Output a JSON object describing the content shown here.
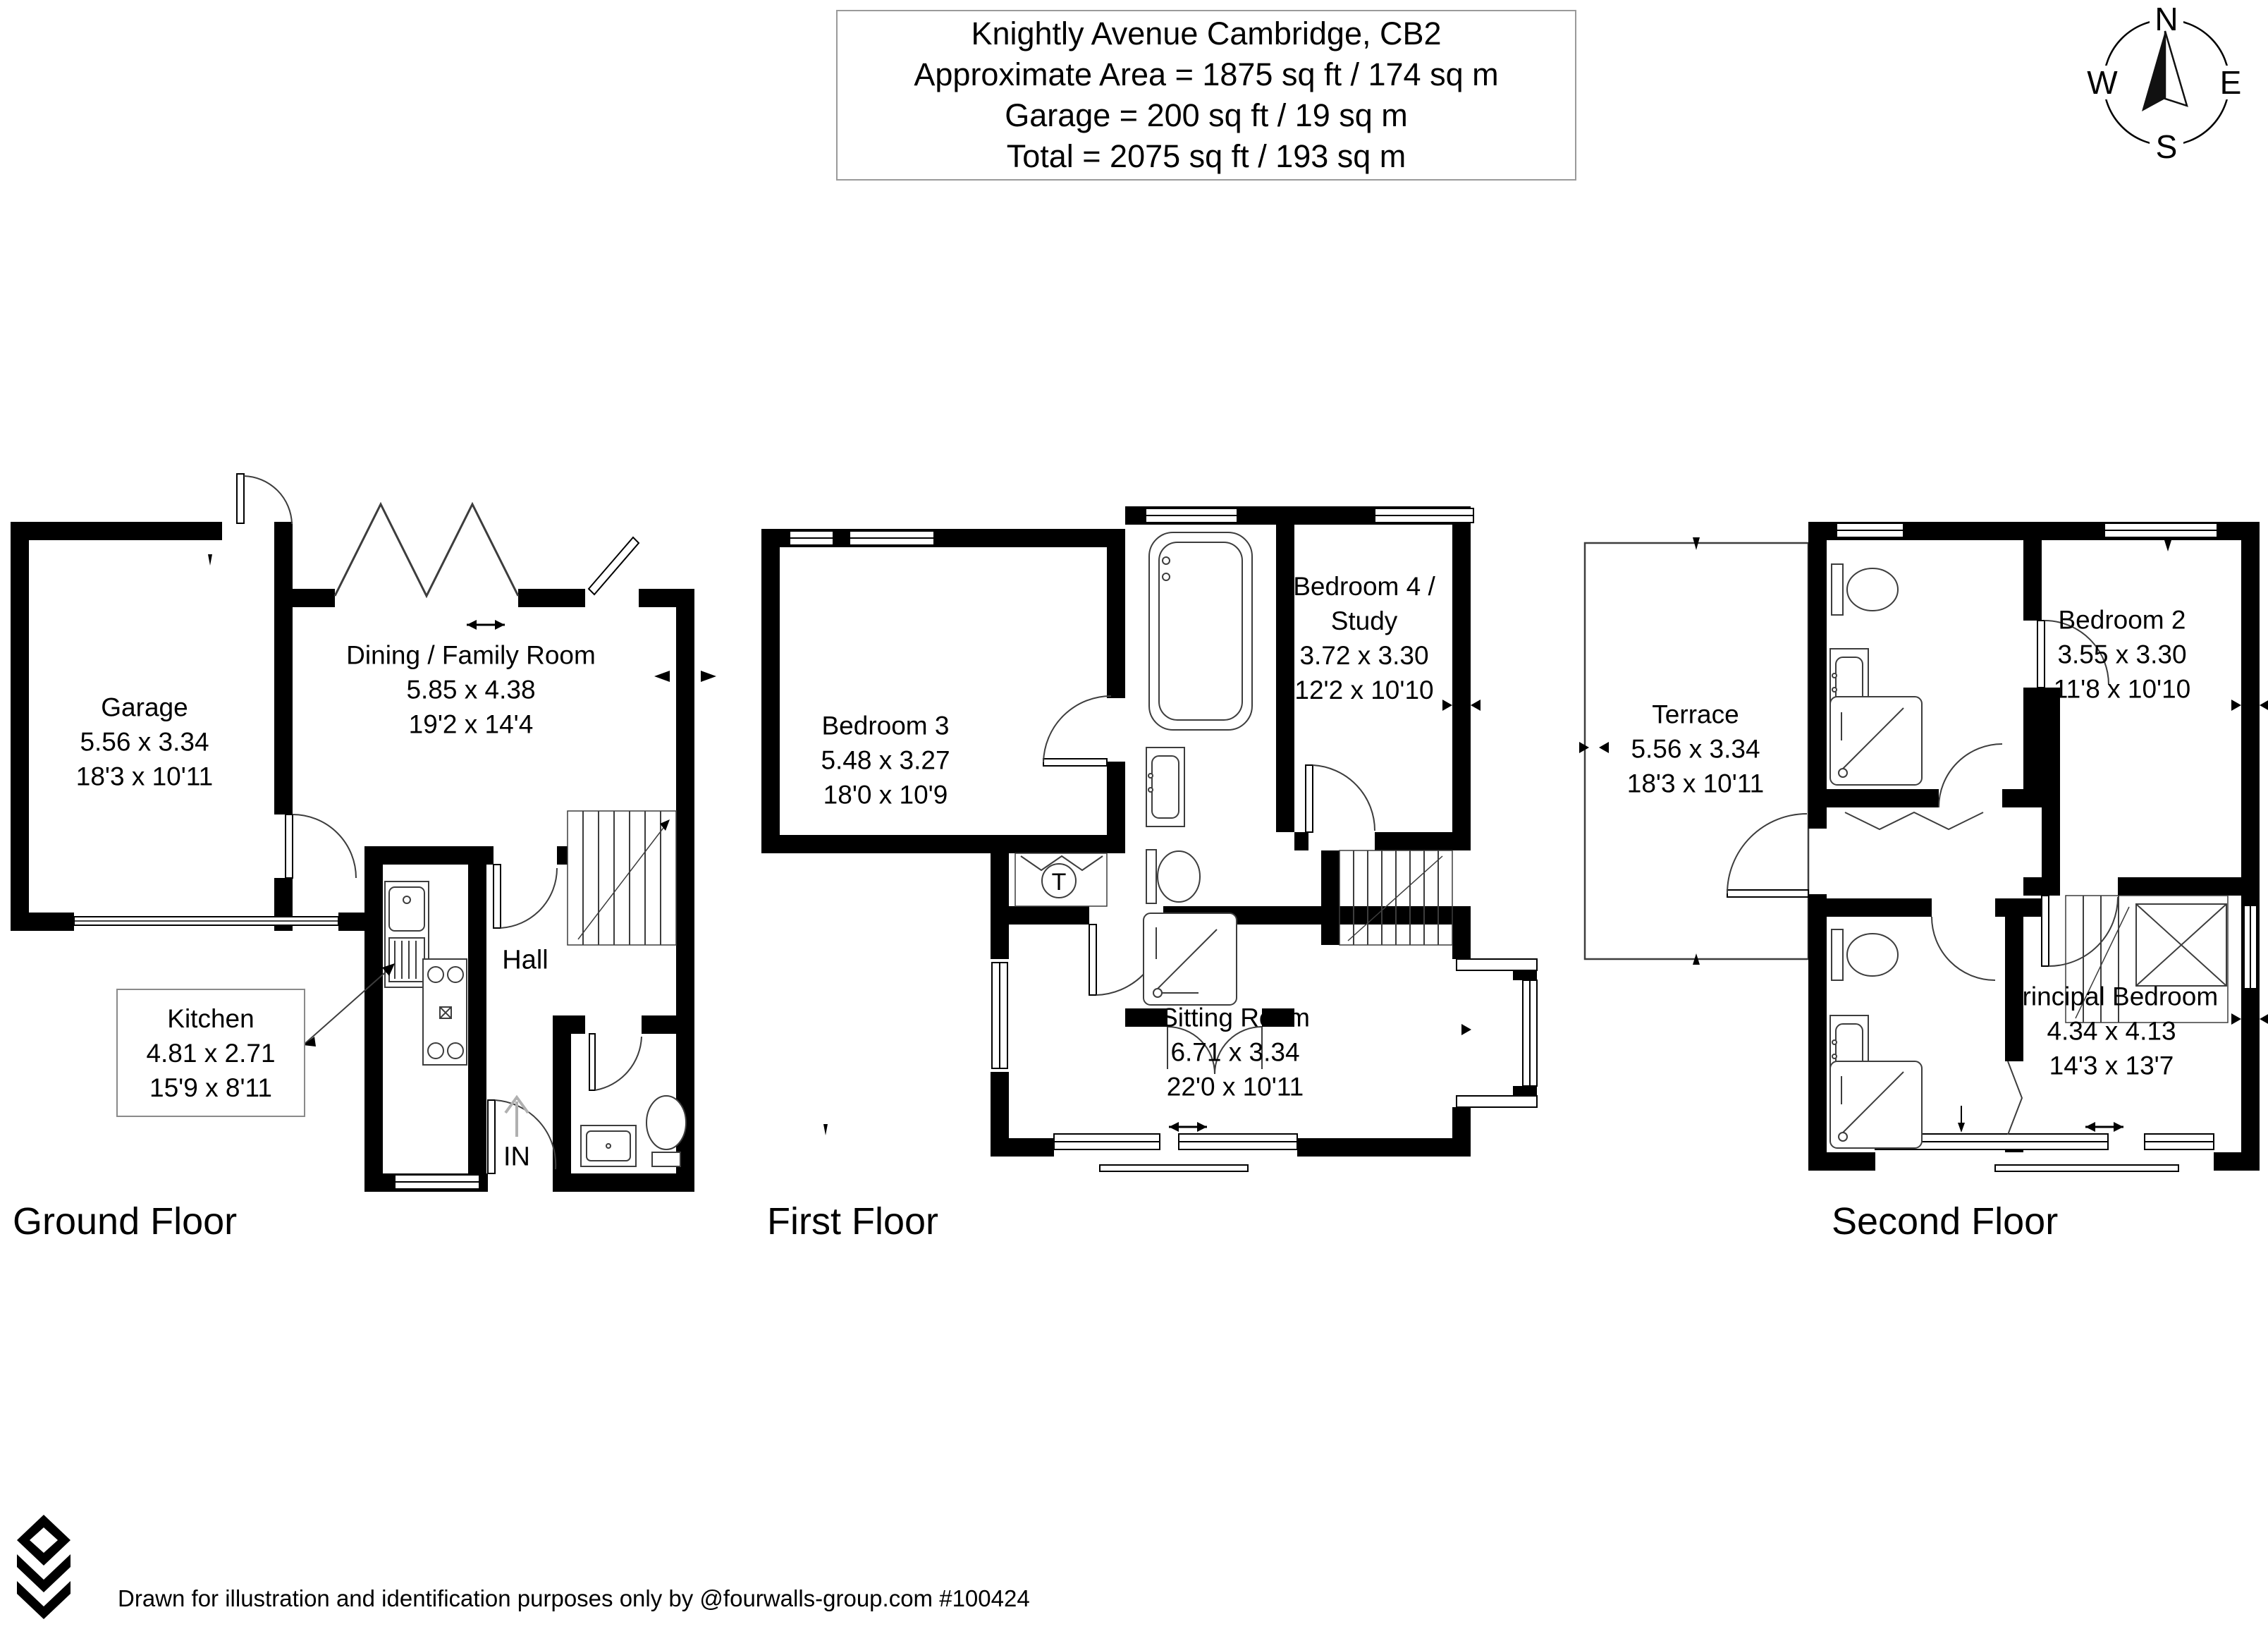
{
  "title_block": {
    "address": "Knightly Avenue Cambridge, CB2",
    "approximate_area": "Approximate Area = 1875 sq ft / 174 sq m",
    "garage_area": "Garage = 200 sq ft / 19 sq m",
    "total_area": "Total = 2075 sq ft / 193 sq m"
  },
  "compass": {
    "north": "N",
    "east": "E",
    "south": "S",
    "west": "W"
  },
  "floors": [
    {
      "name": "Ground Floor",
      "rooms": [
        {
          "name": "Garage",
          "metric": "5.56 x 3.34",
          "imperial": "18'3 x 10'11"
        },
        {
          "name": "Dining / Family Room",
          "metric": "5.85 x 4.38",
          "imperial": "19'2 x 14'4"
        },
        {
          "name": "Kitchen",
          "metric": "4.81 x 2.71",
          "imperial": "15'9 x 8'11"
        }
      ],
      "annotations": {
        "hall": "Hall",
        "entrance": "IN"
      }
    },
    {
      "name": "First Floor",
      "rooms": [
        {
          "name": "Bedroom 3",
          "metric": "5.48 x 3.27",
          "imperial": "18'0 x 10'9"
        },
        {
          "name": "Bedroom 4 / Study",
          "metric": "3.72 x 3.30",
          "imperial": "12'2 x 10'10"
        },
        {
          "name": "Sitting Room",
          "metric": "6.71 x 3.34",
          "imperial": "22'0 x 10'11"
        }
      ],
      "annotations": {
        "tank": "T"
      }
    },
    {
      "name": "Second Floor",
      "rooms": [
        {
          "name": "Terrace",
          "metric": "5.56 x 3.34",
          "imperial": "18'3 x 10'11"
        },
        {
          "name": "Bedroom 2",
          "metric": "3.55 x 3.30",
          "imperial": "11'8 x 10'10"
        },
        {
          "name": "Principal Bedroom",
          "metric": "4.34 x 4.13",
          "imperial": "14'3 x 13'7"
        }
      ],
      "annotations": {}
    }
  ],
  "footer": {
    "disclaimer": "Drawn for illustration and identification purposes only by @fourwalls-group.com #100424"
  },
  "colors": {
    "walls": "#000000",
    "background": "#ffffff",
    "thin_lines": "#3d3d3d"
  }
}
